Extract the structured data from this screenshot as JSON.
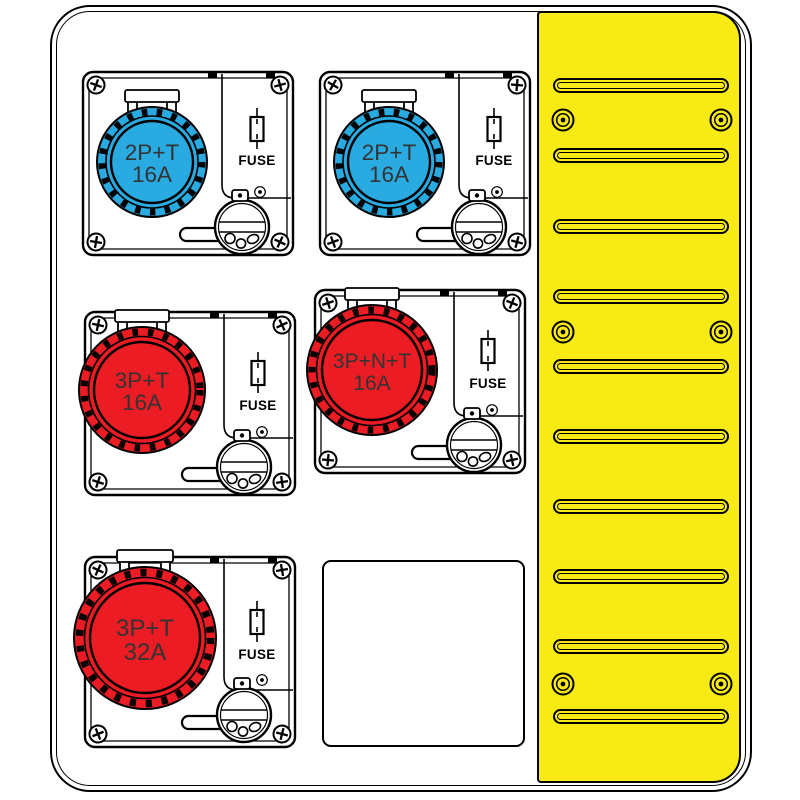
{
  "colors": {
    "outline": "#000000",
    "page_white": "#FFFFFF",
    "socket_blue": "#29ABE2",
    "socket_red": "#EB1C23",
    "vent_yellow": "#F8EA14",
    "label_text": "#333333"
  },
  "modules": [
    {
      "type": "interlocked-socket",
      "socket_label": "2P+T",
      "amp_label": "16A",
      "fuse_label": "FUSE",
      "socket_color": "#29ABE2"
    },
    {
      "type": "interlocked-socket",
      "socket_label": "2P+T",
      "amp_label": "16A",
      "fuse_label": "FUSE",
      "socket_color": "#29ABE2"
    },
    {
      "type": "interlocked-socket",
      "socket_label": "3P+T",
      "amp_label": "16A",
      "fuse_label": "FUSE",
      "socket_color": "#EB1C23"
    },
    {
      "type": "interlocked-socket",
      "socket_label": "3P+N+T",
      "amp_label": "16A",
      "fuse_label": "FUSE",
      "socket_color": "#EB1C23"
    },
    {
      "type": "interlocked-socket",
      "socket_label": "3P+T",
      "amp_label": "32A",
      "fuse_label": "FUSE",
      "socket_color": "#EB1C23"
    },
    {
      "type": "blank-plate"
    }
  ],
  "vent_panel": {
    "color": "#F8EA14",
    "slot_count": 10,
    "screw_count": 6
  }
}
